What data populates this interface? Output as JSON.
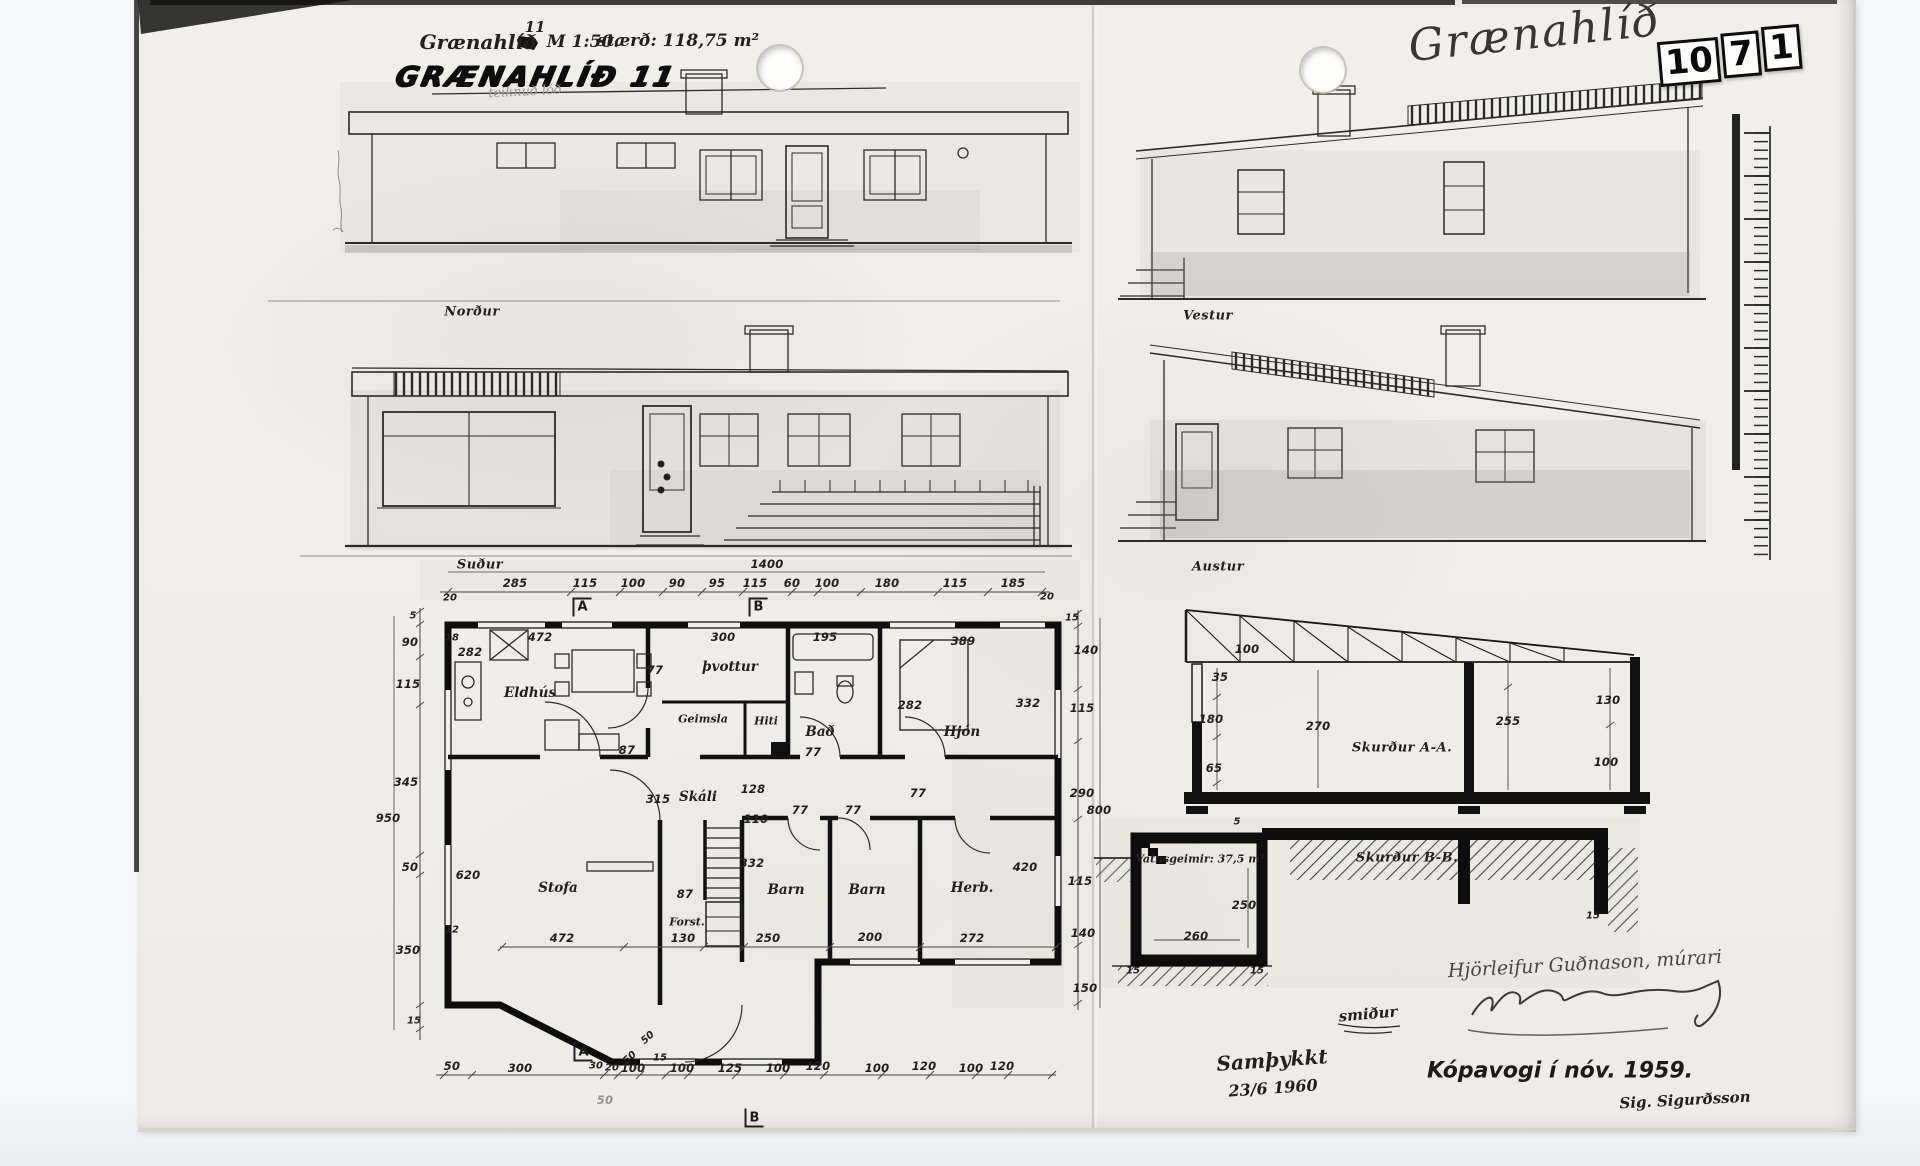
{
  "page": {
    "title_note": {
      "name": "Grænahlíð",
      "number": "11",
      "scale": "M 1:50.",
      "size": "stærð: 118,75 m²"
    },
    "main_title": "GRÆNAHLÍÐ 11",
    "pencil_note": "teiknuð lóð",
    "corner_handwriting": "Grænahlíð",
    "stamp": [
      "10",
      "7",
      "1"
    ]
  },
  "elevations": {
    "north": "Norður",
    "west": "Vestur",
    "south": "Suður",
    "east": "Austur"
  },
  "plan": {
    "rooms": {
      "kitchen": "Eldhús",
      "laundry": "þvottur",
      "storage": "Geimsla",
      "boiler": "Hiti",
      "bath": "Bað",
      "master": "Hjón",
      "hall": "Skáli",
      "living": "Stofa",
      "foyer": "Forst.",
      "child1": "Barn",
      "child2": "Barn",
      "bedroom": "Herb."
    },
    "markers": {
      "a": "A",
      "b": "B"
    }
  },
  "sections": {
    "a": "Skurður A-A.",
    "b": "Skurður B-B.",
    "tank": "Vatnsgeimir: 37,5 m³"
  },
  "footer": {
    "craft_note": "smiður",
    "builder": "Hjörleifur Guðnason, múrari",
    "approved": "Samþykkt",
    "approved_date": "23/6 1960",
    "place_date": "Kópavogi í nóv. 1959.",
    "signature": "Sig. Sigurðsson"
  },
  "dims": {
    "south_total": "1400",
    "south_row": [
      "285",
      "115",
      "100",
      "90",
      "95",
      "115",
      "60",
      "100",
      "180",
      "115",
      "185"
    ],
    "south_end_left": "20",
    "south_end_right": "20",
    "left_col": [
      "5",
      "90",
      "115",
      "345",
      "950",
      "50",
      "350",
      "15"
    ],
    "bottom_row": [
      "50",
      "300",
      "30",
      "20",
      "100",
      "15",
      "100",
      "125",
      "100",
      "120",
      "100",
      "120",
      "100",
      "120"
    ],
    "right_col": [
      "15",
      "140",
      "115",
      "290",
      "800",
      "115",
      "140",
      "150"
    ],
    "plan_inner": [
      "472",
      "300",
      "195",
      "389",
      "282",
      "77",
      "332",
      "282",
      "87",
      "77",
      "620",
      "315",
      "128",
      "110",
      "332",
      "87",
      "77",
      "77",
      "472",
      "130",
      "250",
      "200",
      "272",
      "420",
      "77",
      "18",
      "12"
    ],
    "bay_diag": [
      "50",
      "50"
    ],
    "pencil": "50",
    "section_a": [
      "100",
      "35",
      "180",
      "270",
      "65",
      "255",
      "130",
      "100"
    ],
    "section_b": [
      "5",
      "250",
      "260",
      "15",
      "15",
      "15"
    ]
  }
}
